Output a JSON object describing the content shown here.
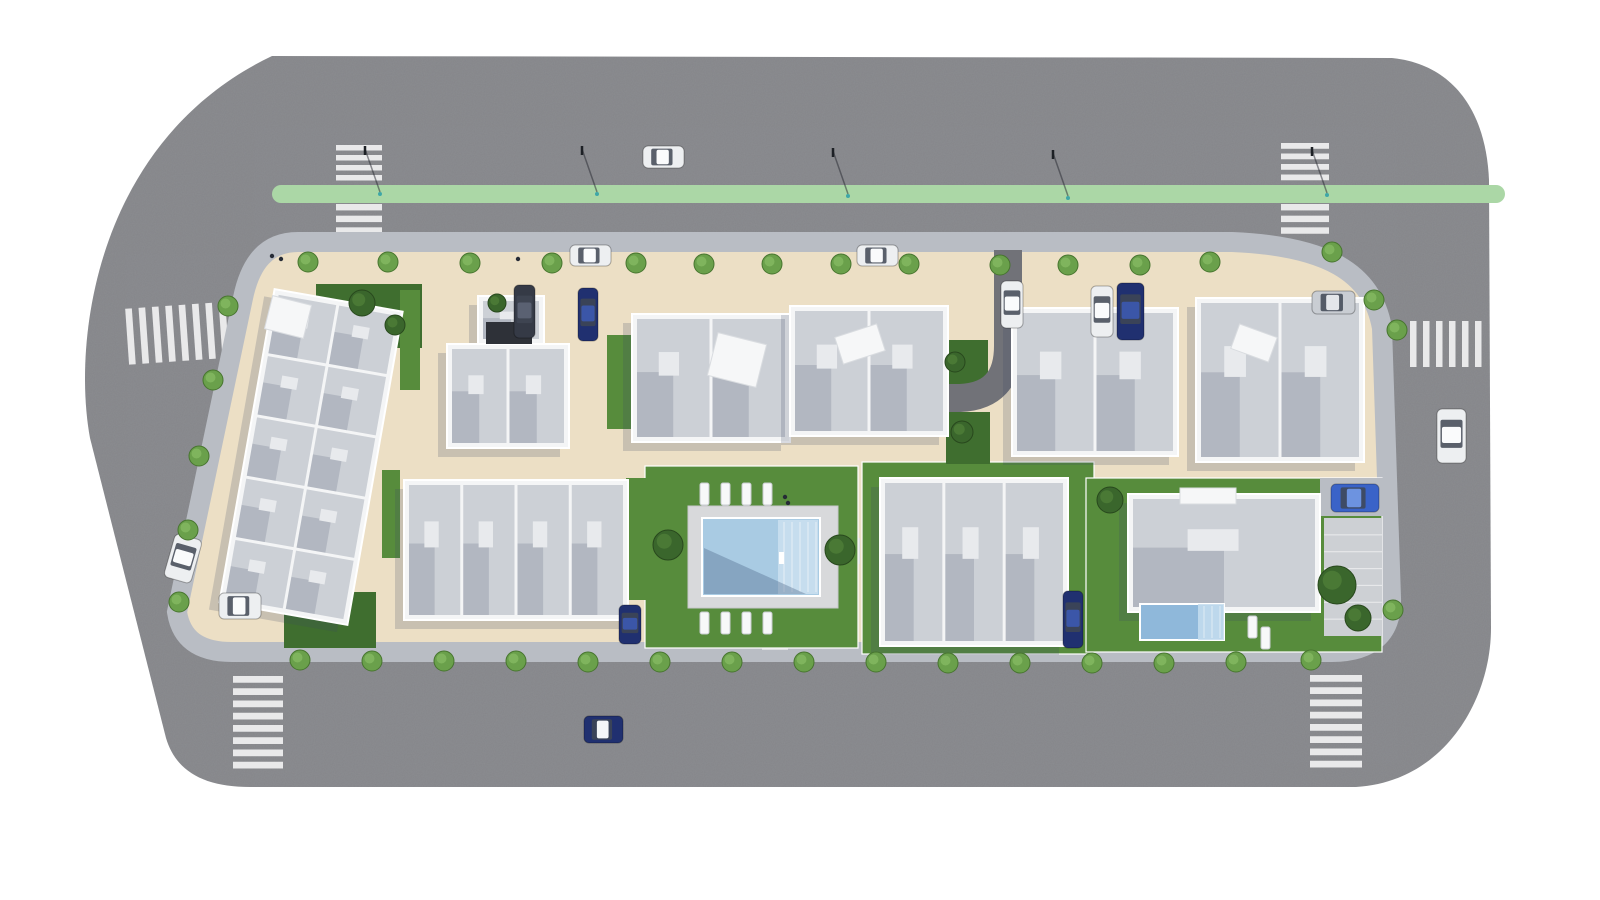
{
  "scene": {
    "label": "aerial-site-plan-render",
    "palette": {
      "background": "#ffffff",
      "road": "#85868a",
      "sidewalk": "#b9bdc4",
      "pavement": "#ecdfc5",
      "crosswalk": "#e9e9ea",
      "median": "#abd7a6",
      "grass": "#578c3c",
      "grass_dark": "#3f6e2f",
      "wall": "#f4f5f6",
      "roof": "#ccd0d6",
      "roof_light": "#e8eaed",
      "deck": "#d8d9db",
      "pool_water": "#a9cbe3",
      "pool_steps": "#c6ddee",
      "villa_pool": "#8fb8da",
      "driveway": "#717278"
    },
    "car_colors": {
      "white": "#edeff1",
      "navy": "#203070",
      "dark": "#353a46",
      "silver": "#c9cdd3",
      "blue": "#3a63c8"
    },
    "car_roofs": {
      "white": "#fafbfc",
      "navy": "#3b56a8",
      "dark": "#5a6172",
      "silver": "#e3e6ea",
      "blue": "#6d93e0"
    },
    "road": {
      "path": "M 272 56 L 1392 58 C 1452 64 1486 110 1489 180 L 1491 628 C 1491 700 1444 782 1356 787 L 250 787 C 205 787 176 772 166 738 L 90 438 C 72 340 96 140 272 56 Z"
    },
    "block": {
      "path": "M 298 242 L 1232 242 C 1326 246 1372 272 1382 328 L 1391 598 C 1392 634 1371 652 1332 652 L 232 652 C 198 652 181 638 177 612 L 243 298 C 250 264 266 242 298 242 Z"
    },
    "median": {
      "x": 272,
      "y": 185,
      "w": 1233,
      "h": 18
    },
    "lane_dashes": {
      "x1": 560,
      "y1": 242,
      "x2": 1232,
      "y2": 242
    },
    "crosswalks": [
      {
        "name": "crosswalk-north-west-upper",
        "x": 336,
        "y": 145,
        "w": 46,
        "h": 40,
        "dir": "v",
        "n": 4,
        "rot": 0
      },
      {
        "name": "crosswalk-north-west-lower",
        "x": 336,
        "y": 204,
        "w": 46,
        "h": 35,
        "dir": "v",
        "n": 3,
        "rot": 0
      },
      {
        "name": "crosswalk-north-east-upper",
        "x": 1281,
        "y": 143,
        "w": 48,
        "h": 42,
        "dir": "v",
        "n": 4,
        "rot": 0
      },
      {
        "name": "crosswalk-north-east-lower",
        "x": 1281,
        "y": 204,
        "w": 48,
        "h": 35,
        "dir": "v",
        "n": 3,
        "rot": 0
      },
      {
        "name": "crosswalk-west",
        "x": 127,
        "y": 305,
        "w": 107,
        "h": 56,
        "dir": "h",
        "n": 8,
        "rot": -4
      },
      {
        "name": "crosswalk-east",
        "x": 1410,
        "y": 321,
        "w": 78,
        "h": 46,
        "dir": "h",
        "n": 6,
        "rot": 0
      },
      {
        "name": "crosswalk-south-west",
        "x": 233,
        "y": 676,
        "w": 50,
        "h": 98,
        "dir": "v",
        "n": 8,
        "rot": 0
      },
      {
        "name": "crosswalk-south-east",
        "x": 1310,
        "y": 675,
        "w": 52,
        "h": 98,
        "dir": "v",
        "n": 8,
        "rot": 0
      }
    ],
    "walk_paths": [
      {
        "name": "pool-path-north",
        "x": 762,
        "y": 466,
        "w": 26,
        "h": 44
      },
      {
        "name": "pool-path-south",
        "x": 762,
        "y": 606,
        "w": 26,
        "h": 44
      },
      {
        "name": "pool-path-east",
        "x": 838,
        "y": 538,
        "w": 22,
        "h": 26
      }
    ],
    "lawns": [
      {
        "name": "lawn-northwest",
        "x": 316,
        "y": 284,
        "w": 106,
        "h": 64,
        "dark": true,
        "fence": false
      },
      {
        "name": "lawn-b2-west",
        "x": 400,
        "y": 290,
        "w": 20,
        "h": 100,
        "dark": false,
        "fence": false
      },
      {
        "name": "lawn-b2-east",
        "x": 607,
        "y": 335,
        "w": 24,
        "h": 94,
        "dark": false,
        "fence": false
      },
      {
        "name": "lawn-pool-garden",
        "x": 645,
        "y": 466,
        "w": 213,
        "h": 182,
        "dark": false,
        "fence": true
      },
      {
        "name": "lawn-row-center",
        "x": 862,
        "y": 462,
        "w": 232,
        "h": 192,
        "dark": false,
        "fence": true
      },
      {
        "name": "lawn-villa",
        "x": 1086,
        "y": 478,
        "w": 296,
        "h": 174,
        "dark": false,
        "fence": true
      },
      {
        "name": "lawn-driveway-north",
        "x": 948,
        "y": 340,
        "w": 40,
        "h": 50,
        "dark": true,
        "fence": false
      },
      {
        "name": "lawn-driveway-south",
        "x": 946,
        "y": 412,
        "w": 44,
        "h": 52,
        "dark": true,
        "fence": false
      },
      {
        "name": "lawn-southwest",
        "x": 284,
        "y": 592,
        "w": 92,
        "h": 56,
        "dark": true,
        "fence": false
      },
      {
        "name": "lawn-row1-east",
        "x": 626,
        "y": 478,
        "w": 20,
        "h": 122,
        "dark": false,
        "fence": false
      },
      {
        "name": "lawn-row1-west",
        "x": 382,
        "y": 470,
        "w": 18,
        "h": 88,
        "dark": false,
        "fence": false
      }
    ],
    "driveway": {
      "path": "M 1008 250 L 1008 346 Q 1008 396 960 398 L 934 398",
      "width": 28
    },
    "pads": [
      {
        "name": "villa-parking-pad",
        "x": 1320,
        "y": 478,
        "w": 66,
        "h": 38
      }
    ],
    "walkway": {
      "name": "villa-walkway",
      "x": 1324,
      "y": 518,
      "w": 58,
      "h": 118,
      "lines": 7
    },
    "buildings": [
      {
        "name": "terraced-houses-west",
        "x": 246,
        "y": 298,
        "w": 130,
        "h": 318,
        "rot": 10,
        "rows": 5,
        "cols": 2
      },
      {
        "name": "apartment-b2-garage",
        "x": 478,
        "y": 296,
        "w": 66,
        "h": 48,
        "rot": 0,
        "rows": 1,
        "cols": 1
      },
      {
        "name": "apartment-b2",
        "x": 447,
        "y": 344,
        "w": 122,
        "h": 104,
        "rot": 0,
        "rows": 1,
        "cols": 2
      },
      {
        "name": "apartment-center-west",
        "x": 632,
        "y": 314,
        "w": 158,
        "h": 128,
        "rot": 0,
        "rows": 1,
        "cols": 2
      },
      {
        "name": "apartment-center-east",
        "x": 790,
        "y": 306,
        "w": 158,
        "h": 130,
        "rot": 0,
        "rows": 1,
        "cols": 2
      },
      {
        "name": "apartment-b4",
        "x": 1012,
        "y": 308,
        "w": 166,
        "h": 148,
        "rot": 0,
        "rows": 1,
        "cols": 2
      },
      {
        "name": "apartment-b5-east",
        "x": 1196,
        "y": 298,
        "w": 168,
        "h": 164,
        "rot": 0,
        "rows": 1,
        "cols": 2
      },
      {
        "name": "townhouse-row-south-west",
        "x": 404,
        "y": 480,
        "w": 224,
        "h": 140,
        "rot": 0,
        "rows": 1,
        "cols": 4
      },
      {
        "name": "townhouse-row-south-center",
        "x": 880,
        "y": 478,
        "w": 188,
        "h": 168,
        "rot": 0,
        "rows": 1,
        "cols": 3
      },
      {
        "name": "villa-south-east",
        "x": 1128,
        "y": 494,
        "w": 192,
        "h": 118,
        "rot": 0,
        "rows": 1,
        "cols": 1
      }
    ],
    "roof_features": [
      {
        "x": 712,
        "y": 338,
        "w": 50,
        "h": 44,
        "rot": 14
      },
      {
        "x": 838,
        "y": 330,
        "w": 44,
        "h": 28,
        "rot": -18
      },
      {
        "x": 1234,
        "y": 330,
        "w": 40,
        "h": 26,
        "rot": 20
      },
      {
        "x": 268,
        "y": 300,
        "w": 40,
        "h": 34,
        "rot": 14
      },
      {
        "x": 1180,
        "y": 488,
        "w": 56,
        "h": 16,
        "rot": 0
      }
    ],
    "solar_panels": {
      "x": 486,
      "y": 322,
      "w": 46,
      "h": 22
    },
    "pool": {
      "deck": {
        "x": 688,
        "y": 506,
        "w": 150,
        "h": 102
      },
      "water": {
        "x": 702,
        "y": 518,
        "w": 118,
        "h": 78
      },
      "steps": {
        "x": 778,
        "y": 520,
        "w": 40,
        "h": 74
      },
      "shadow_points": "704,548 704,594 806,594",
      "ladder": {
        "x": 779,
        "y": 552,
        "w": 5,
        "h": 12
      }
    },
    "villa_pool": {
      "x": 1140,
      "y": 604,
      "w": 84,
      "h": 36,
      "steps_w": 26
    },
    "loungers": [
      {
        "x": 700,
        "y": 483
      },
      {
        "x": 721,
        "y": 483
      },
      {
        "x": 742,
        "y": 483
      },
      {
        "x": 763,
        "y": 483
      },
      {
        "x": 700,
        "y": 612
      },
      {
        "x": 721,
        "y": 612
      },
      {
        "x": 742,
        "y": 612
      },
      {
        "x": 763,
        "y": 612
      },
      {
        "x": 1248,
        "y": 616
      },
      {
        "x": 1261,
        "y": 627
      }
    ],
    "cars": [
      {
        "name": "car-sedan-north-road",
        "x": 643,
        "y": 146,
        "w": 41,
        "h": 22,
        "rot": 0,
        "color": "white"
      },
      {
        "name": "car-parked-north-1",
        "x": 570,
        "y": 245,
        "w": 41,
        "h": 21,
        "rot": 0,
        "color": "white"
      },
      {
        "name": "car-parked-north-2",
        "x": 857,
        "y": 245,
        "w": 41,
        "h": 21,
        "rot": 0,
        "color": "white"
      },
      {
        "name": "car-east-road",
        "x": 1437,
        "y": 409,
        "w": 29,
        "h": 54,
        "rot": 0,
        "color": "white"
      },
      {
        "name": "car-west-road",
        "x": 169,
        "y": 536,
        "w": 28,
        "h": 45,
        "rot": 16,
        "color": "white"
      },
      {
        "name": "car-parked-west-block",
        "x": 219,
        "y": 593,
        "w": 42,
        "h": 26,
        "rot": 0,
        "color": "white"
      },
      {
        "name": "car-south-road",
        "x": 584,
        "y": 716,
        "w": 39,
        "h": 27,
        "rot": 0,
        "color": "navy",
        "roof": "white"
      },
      {
        "name": "car-driveway",
        "x": 1001,
        "y": 281,
        "w": 22,
        "h": 47,
        "rot": 0,
        "color": "white"
      },
      {
        "name": "car-b4-parked-white",
        "x": 1091,
        "y": 286,
        "w": 22,
        "h": 51,
        "rot": 0,
        "color": "white"
      },
      {
        "name": "car-b4-parked-blue",
        "x": 1117,
        "y": 283,
        "w": 27,
        "h": 57,
        "rot": 0,
        "color": "navy"
      },
      {
        "name": "van-b2-parked",
        "x": 514,
        "y": 285,
        "w": 21,
        "h": 53,
        "rot": 0,
        "color": "dark"
      },
      {
        "name": "car-b2-parked-blue",
        "x": 578,
        "y": 288,
        "w": 20,
        "h": 53,
        "rot": 0,
        "color": "navy"
      },
      {
        "name": "car-b5-courtyard",
        "x": 1312,
        "y": 291,
        "w": 43,
        "h": 23,
        "rot": 0,
        "color": "silver"
      },
      {
        "name": "car-villa-parked",
        "x": 1331,
        "y": 484,
        "w": 48,
        "h": 28,
        "rot": 0,
        "color": "blue"
      },
      {
        "name": "car-row-south-parked",
        "x": 1063,
        "y": 591,
        "w": 20,
        "h": 57,
        "rot": 0,
        "color": "navy"
      },
      {
        "name": "car-pool-south-parked",
        "x": 619,
        "y": 605,
        "w": 22,
        "h": 39,
        "rot": 0,
        "color": "navy"
      }
    ],
    "street_trees": [
      [
        308,
        262
      ],
      [
        388,
        262
      ],
      [
        470,
        263
      ],
      [
        552,
        263
      ],
      [
        636,
        263
      ],
      [
        704,
        264
      ],
      [
        772,
        264
      ],
      [
        841,
        264
      ],
      [
        909,
        264
      ],
      [
        1000,
        265
      ],
      [
        1068,
        265
      ],
      [
        1140,
        265
      ],
      [
        1210,
        262
      ],
      [
        1332,
        252
      ],
      [
        228,
        306
      ],
      [
        213,
        380
      ],
      [
        199,
        456
      ],
      [
        188,
        530
      ],
      [
        179,
        602
      ],
      [
        1374,
        300
      ],
      [
        1397,
        330
      ],
      [
        1393,
        610
      ],
      [
        1311,
        660
      ],
      [
        300,
        660
      ],
      [
        372,
        661
      ],
      [
        444,
        661
      ],
      [
        516,
        661
      ],
      [
        588,
        662
      ],
      [
        660,
        662
      ],
      [
        732,
        662
      ],
      [
        804,
        662
      ],
      [
        876,
        662
      ],
      [
        948,
        663
      ],
      [
        1020,
        663
      ],
      [
        1092,
        663
      ],
      [
        1164,
        663
      ],
      [
        1236,
        662
      ]
    ],
    "garden_trees": [
      [
        362,
        303,
        13
      ],
      [
        395,
        325,
        10
      ],
      [
        497,
        303,
        9
      ],
      [
        668,
        545,
        15
      ],
      [
        840,
        550,
        15
      ],
      [
        955,
        362,
        10
      ],
      [
        962,
        432,
        11
      ],
      [
        1110,
        500,
        13
      ],
      [
        1337,
        585,
        19
      ],
      [
        1358,
        618,
        13
      ]
    ],
    "lamps": [
      [
        365,
        146
      ],
      [
        582,
        146
      ],
      [
        833,
        148
      ],
      [
        1053,
        150
      ],
      [
        1312,
        147
      ]
    ],
    "pedestrians": [
      [
        272,
        256
      ],
      [
        281,
        259
      ],
      [
        518,
        259
      ],
      [
        785,
        497
      ],
      [
        788,
        503
      ]
    ]
  }
}
